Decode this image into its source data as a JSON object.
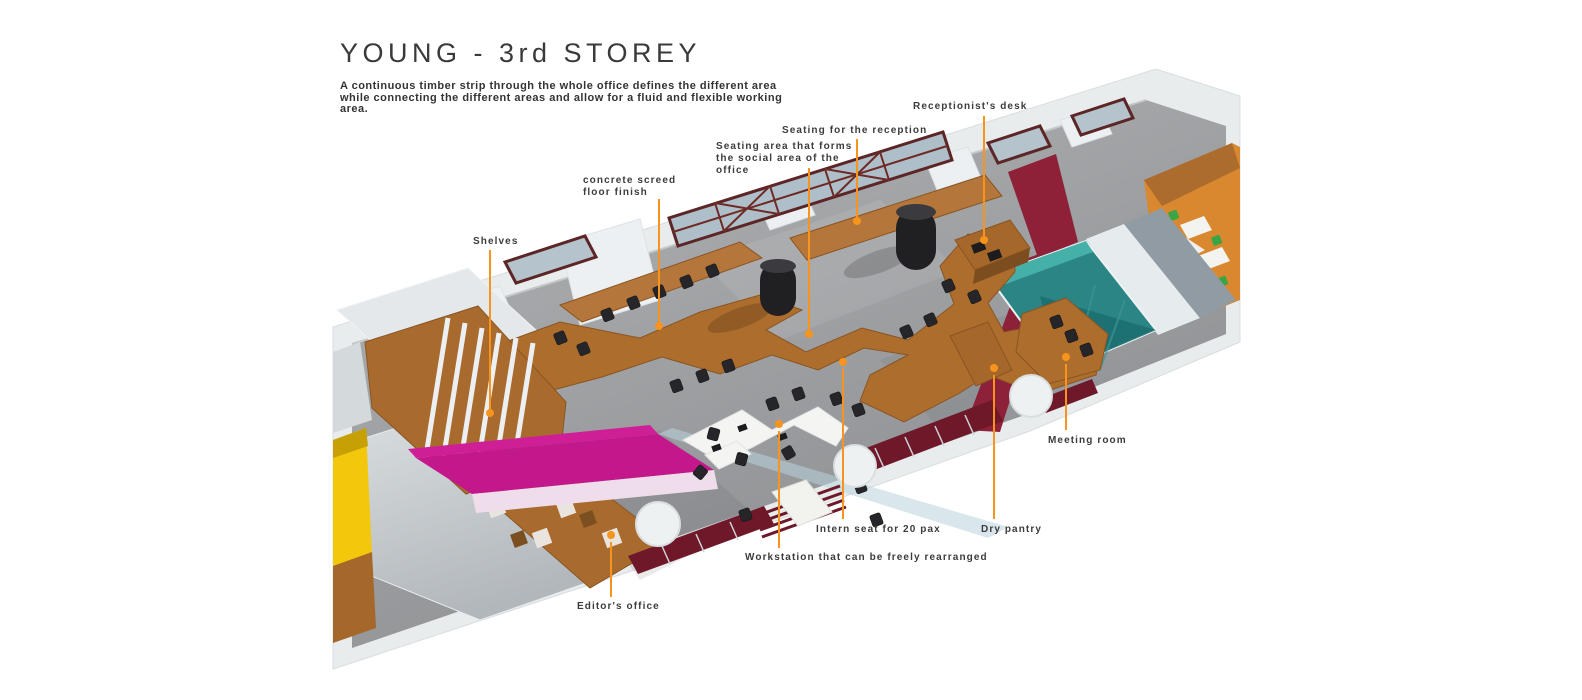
{
  "header": {
    "title": "YOUNG - 3rd STOREY",
    "description": "A continuous timber strip through the whole office defines the different area while connecting the different areas and allow for a fluid and flexible working area."
  },
  "annotations": [
    {
      "id": "receptionist-desk",
      "text": "Receptionist's desk"
    },
    {
      "id": "seating-reception",
      "text": "Seating for the reception"
    },
    {
      "id": "seating-social",
      "text": "Seating area that forms the social area of the office"
    },
    {
      "id": "concrete-screed",
      "text": "concrete screed floor finish"
    },
    {
      "id": "shelves",
      "text": "Shelves"
    },
    {
      "id": "editors-office",
      "text": "Editor's office"
    },
    {
      "id": "workstation",
      "text": "Workstation that can be freely rearranged"
    },
    {
      "id": "intern-seat",
      "text": "Intern seat for 20 pax"
    },
    {
      "id": "dry-pantry",
      "text": "Dry pantry"
    },
    {
      "id": "meeting-room",
      "text": "Meeting room"
    }
  ],
  "colors": {
    "leader_line": "#F7941E",
    "timber": "#AD6D2D",
    "magenta_wall": "#C2188C",
    "teal_meeting_room": "#2A8584",
    "maroon_wall": "#8E2038",
    "yellow_accent": "#F3C70B",
    "floor_gray": "#9FA1A4",
    "wall_white": "#E9ECED",
    "adjacent_floor_orange": "#D9882F",
    "text": "#3C3C3C"
  },
  "floorplan": {
    "view": "axonometric 3D render",
    "label": "3rd storey office floor plan"
  }
}
